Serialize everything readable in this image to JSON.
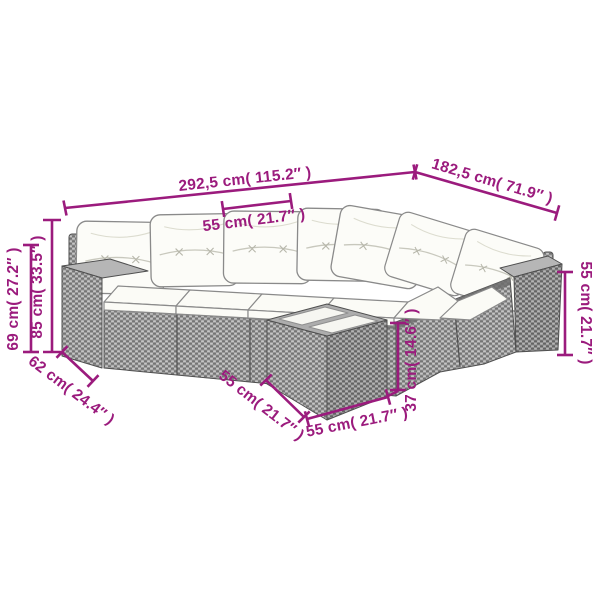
{
  "colors": {
    "dimension": "#9b1b7d",
    "outline": "#4f4f4f",
    "rattan": "#9d9d9d",
    "cushion": "#fbfbf6"
  },
  "dimensions": {
    "total_width": {
      "label": "292,5 cm( 115.2″ )"
    },
    "total_depth": {
      "label": "182,5 cm( 71.9″ )"
    },
    "seat_width": {
      "label": "55 cm( 21.7″ )"
    },
    "height_back": {
      "label": "85 cm( 33.5″ )"
    },
    "height_secondary": {
      "label": "69 cm( 27.2″ )"
    },
    "depth_armrest": {
      "label": "62 cm( 24.4″ )"
    },
    "table_side": {
      "label": "55 cm( 21.7″ )"
    },
    "table_front": {
      "label": "55 cm( 21.7″ )"
    },
    "table_height": {
      "label": "37 cm( 14.6″ )"
    },
    "height_armrest": {
      "label": "55 cm( 21.7″ )"
    }
  }
}
